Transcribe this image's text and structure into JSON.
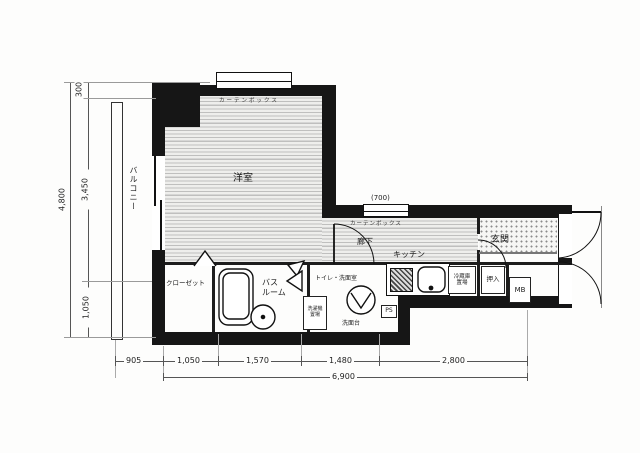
{
  "rooms": {
    "main_room": "洋室",
    "balcony": "バルコニー",
    "hallway": "廊下",
    "kitchen": "キッチン",
    "entrance": "玄関",
    "closet": "クローゼット",
    "bathroom_line1": "バス",
    "bathroom_line2": "ルーム",
    "toilet_washroom": "トイレ・洗面室",
    "oshiire": "押入",
    "meter_box": "MB"
  },
  "fixtures": {
    "fridge_line1": "冷蔵庫",
    "fridge_line2": "置場",
    "washer_line1": "洗濯機",
    "washer_line2": "置場",
    "vanity": "洗面台",
    "pipe_space": "PS",
    "curtain_box_main": "カーテンボックス",
    "curtain_box_hall": "カーテンボックス",
    "hall_window_width": "(700)"
  },
  "dimensions": {
    "left_total": "4,800",
    "left_seg_top": "300",
    "left_seg_mid": "3,450",
    "left_seg_bottom": "1,050",
    "bottom_balcony": "905",
    "bottom_seg1": "1,050",
    "bottom_seg2": "1,570",
    "bottom_seg3": "1,480",
    "bottom_seg4": "2,800",
    "bottom_total": "6,900"
  }
}
